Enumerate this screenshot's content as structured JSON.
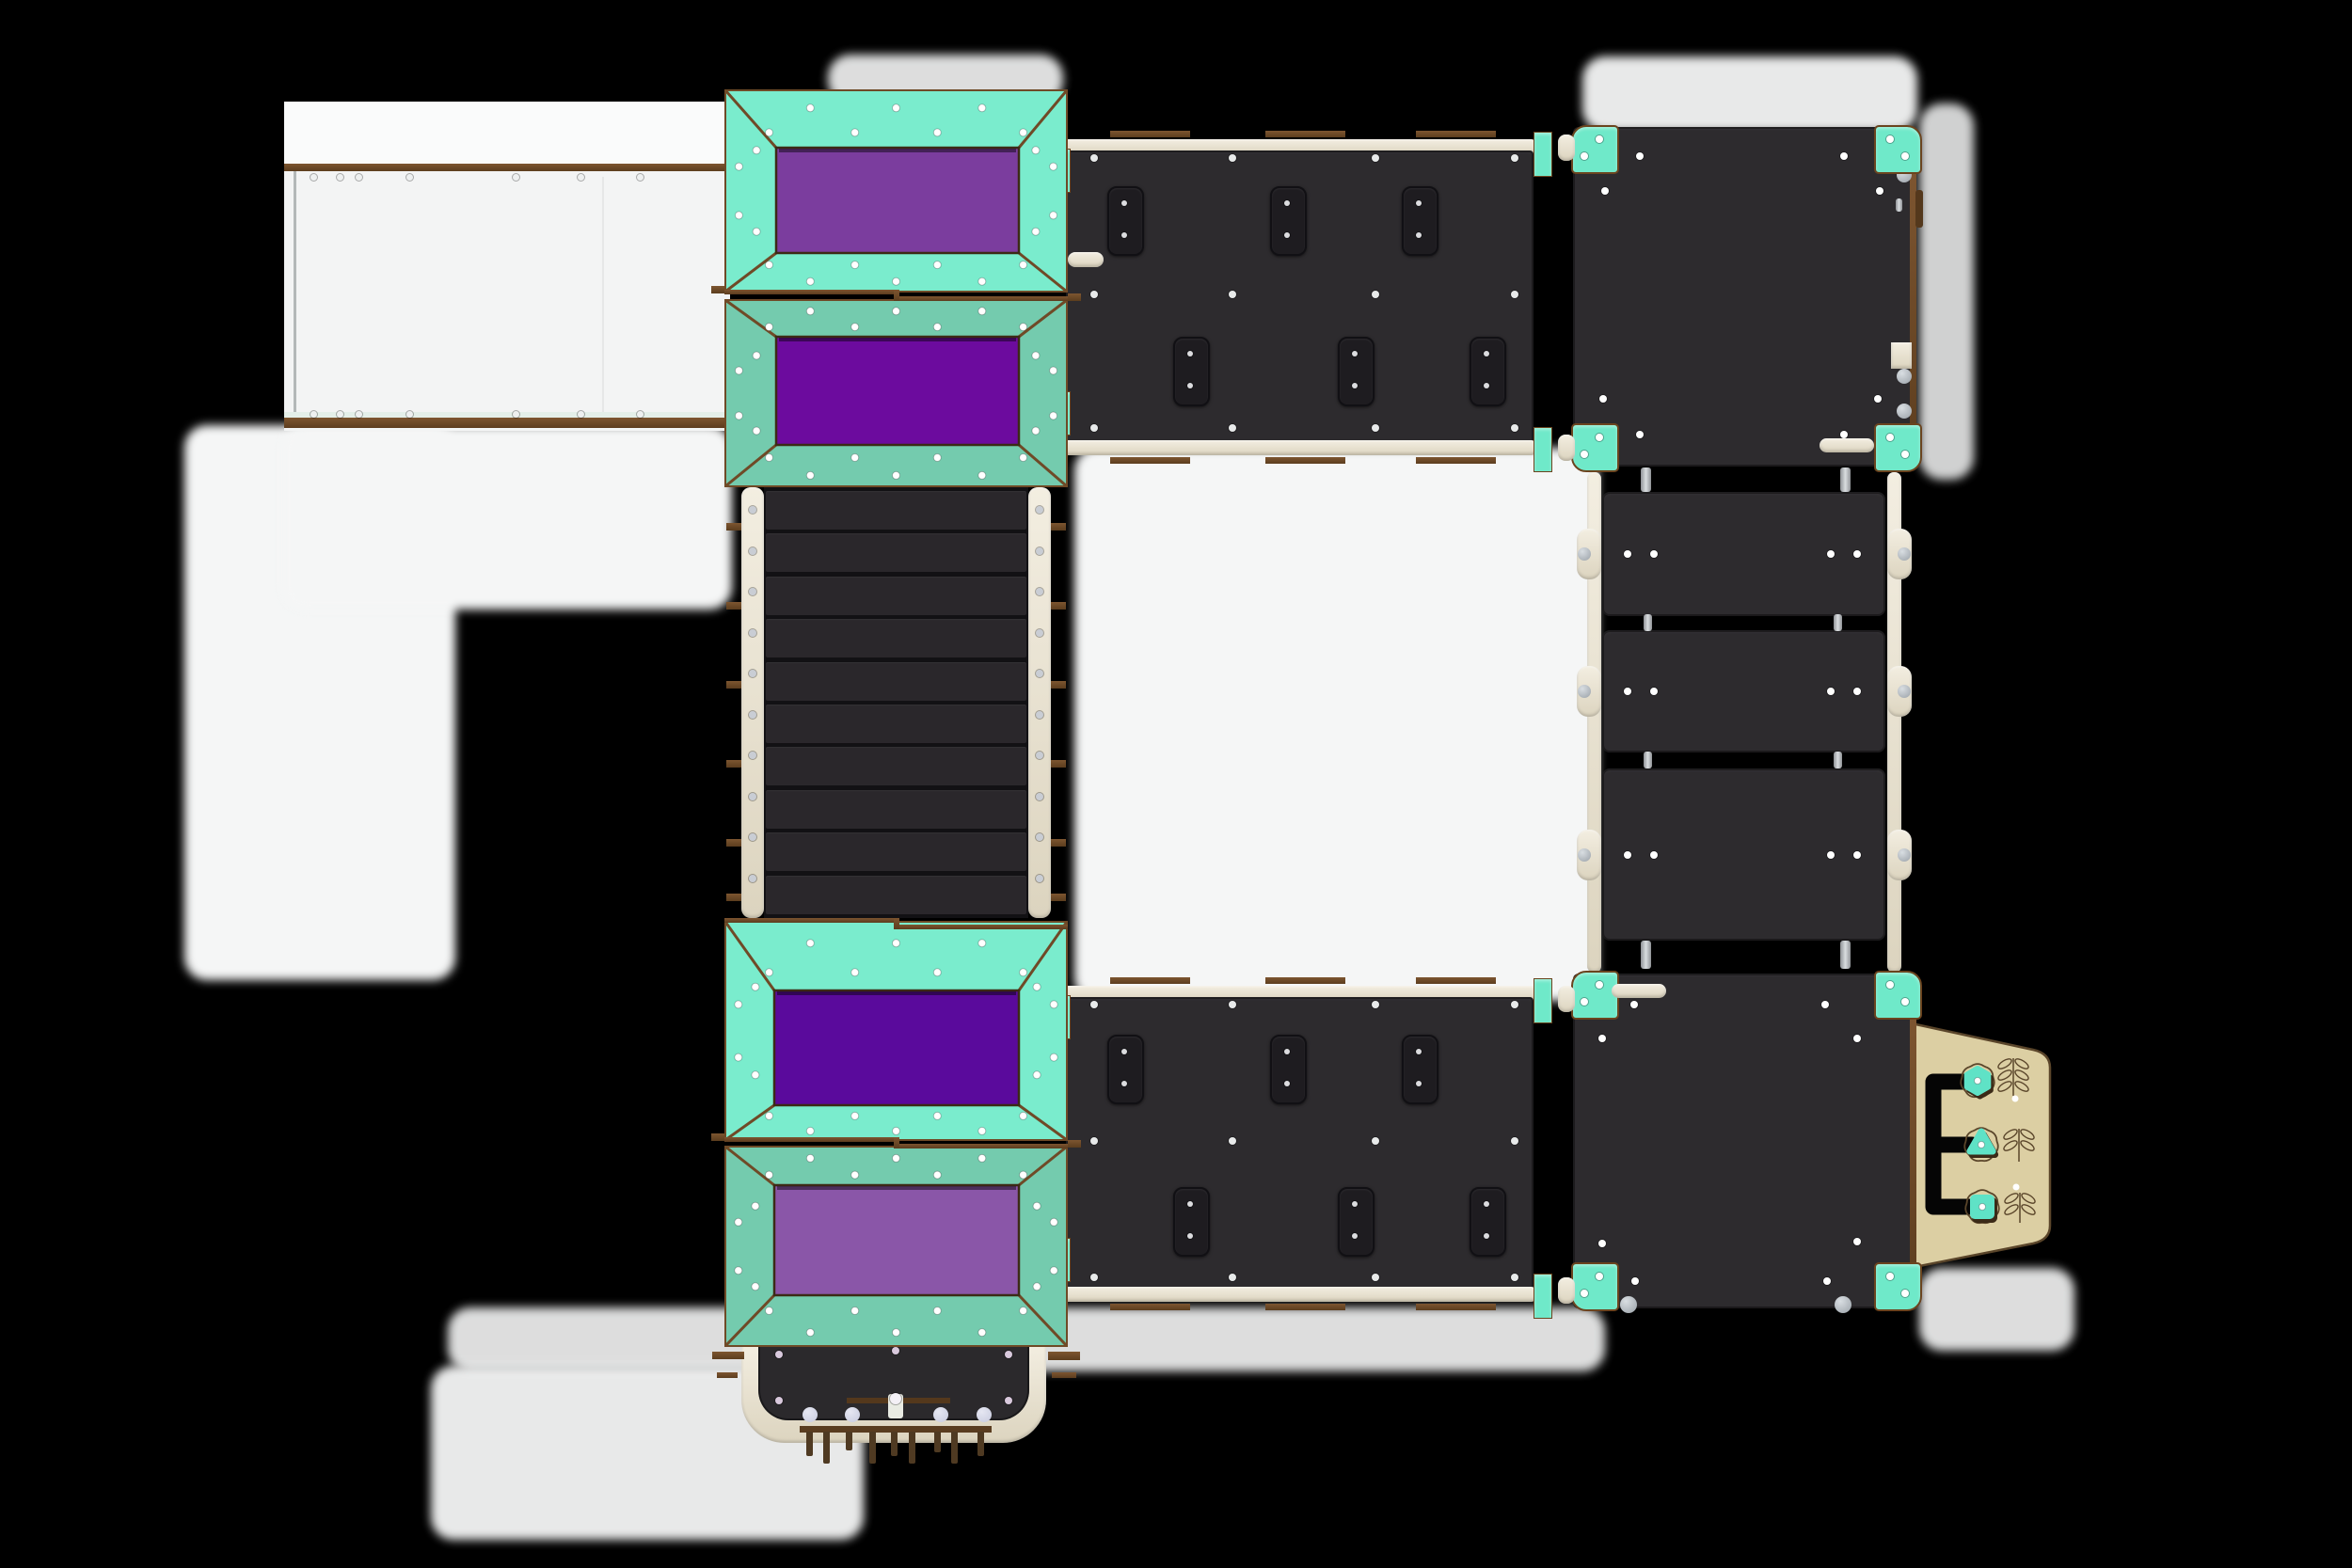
{
  "scene": {
    "title": "Playground equipment top view render",
    "view": "top-down orthographic",
    "background": "transparent shown as black with white ground shadow patches"
  },
  "colors": {
    "background": "#000000",
    "ground_white": "#f5f6f6",
    "teal_bright": "#7aeccd",
    "teal_sea": "#74cbae",
    "teal_bracket": "#6fe9c9",
    "teal_knob": "#5fe2c6",
    "purple_medium": "#7b3d9e",
    "purple_deep": "#6c0b9e",
    "purple_deep_dark": "#5a0a9c",
    "purple_soft": "#8a56a8",
    "wood": "#6f4a27",
    "wood_dark": "#54381c",
    "panel_dark": "#2d2b2e",
    "hold_dark": "#1e1c20",
    "slat": "#2a272b",
    "slat_gap": "#121114",
    "cream": "#ece6d7",
    "beige": "#dccfa3",
    "beige_line": "#5a452a",
    "metal": "#b9bcc0",
    "knob_gray": "#a9aeb3",
    "rivet": "#ffffff",
    "ball_pale": "#c7cade"
  },
  "components": {
    "left_wall": {
      "rails": 2,
      "rivets_per_rail": 7
    },
    "roofs": [
      {
        "id": "roof-upper-top",
        "frame": "teal_bright",
        "panel": "purple_medium"
      },
      {
        "id": "roof-upper-bottom",
        "frame": "teal_sea",
        "panel": "purple_deep"
      },
      {
        "id": "roof-lower-top",
        "frame": "teal_bright",
        "panel": "purple_deep_dark"
      },
      {
        "id": "roof-lower-bottom",
        "frame": "teal_sea",
        "panel": "purple_soft"
      }
    ],
    "bridge": {
      "slat_count": 10,
      "rail_rivet_count": 10,
      "side_stub_count": 6
    },
    "climbing_walls": [
      {
        "hold_count": 6
      },
      {
        "hold_count": 6
      }
    ],
    "platforms": [
      {
        "corner_bracket_count": 4,
        "handle": "bottom-right",
        "edge_latch": true
      },
      {
        "corner_bracket_count": 4,
        "handle": "top-left",
        "edge_latch": false
      }
    ],
    "stairs": {
      "step_count": 3,
      "rivets_per_step": 4
    },
    "activity_panel": {
      "flower_count": 3,
      "knobs": [
        "hexagon",
        "triangle",
        "square"
      ],
      "track_branches": 3,
      "engraved_rivets": 2
    },
    "entrance": {
      "peg_count": 9,
      "ball_count": 4
    }
  }
}
